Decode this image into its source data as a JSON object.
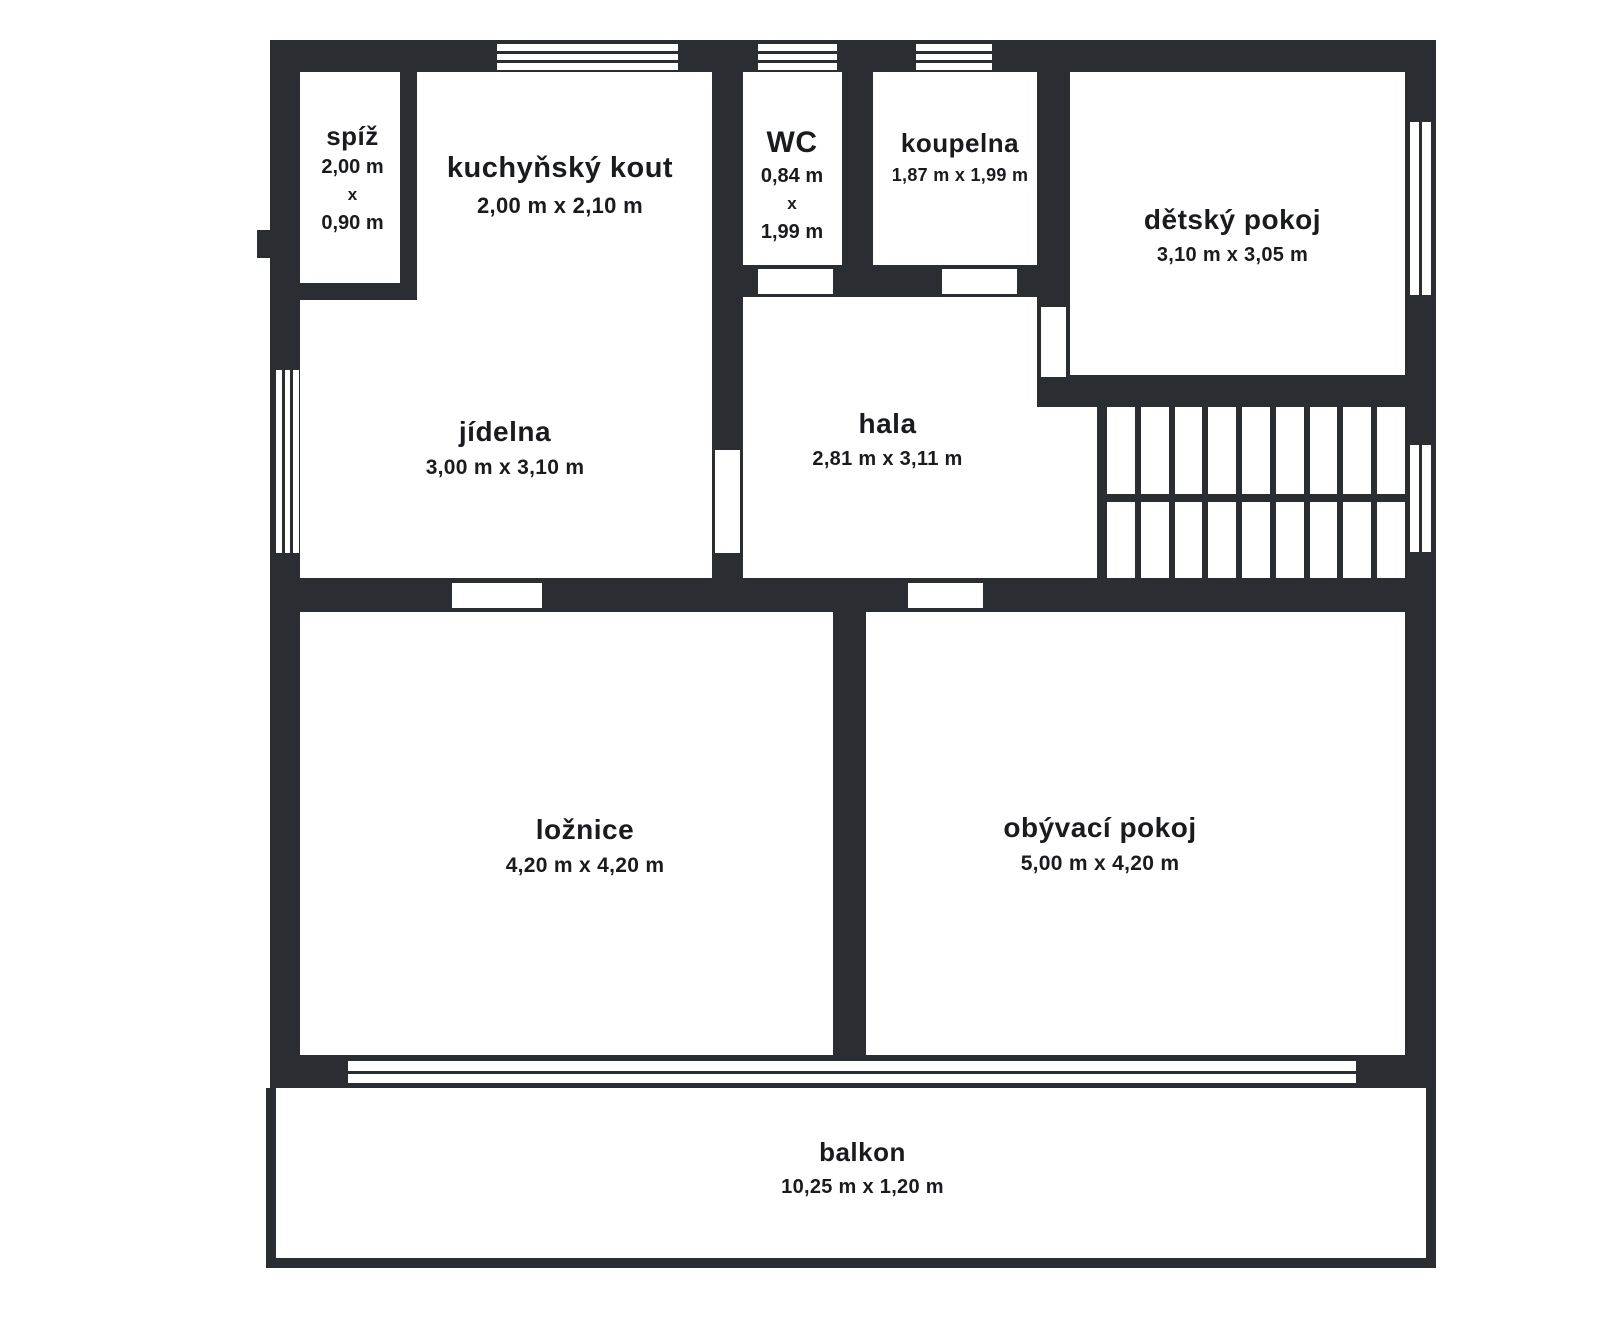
{
  "plan": {
    "wall_color": "#2a2d32",
    "text_color": "#191b1f",
    "background_color": "#ffffff",
    "rooms": [
      {
        "id": "spiz",
        "name": "spíž",
        "dims": [
          "2,00 m",
          "x",
          "0,90 m"
        ]
      },
      {
        "id": "kuchynsky-kout",
        "name": "kuchyňský kout",
        "dims": "2,00 m x 2,10 m"
      },
      {
        "id": "wc",
        "name": "WC",
        "dims": [
          "0,84 m",
          "x",
          "1,99 m"
        ]
      },
      {
        "id": "koupelna",
        "name": "koupelna",
        "dims": "1,87 m x 1,99 m"
      },
      {
        "id": "detsky-pokoj",
        "name": "dětský pokoj",
        "dims": "3,10 m x 3,05 m"
      },
      {
        "id": "jidelna",
        "name": "jídelna",
        "dims": "3,00 m x 3,10 m"
      },
      {
        "id": "hala",
        "name": "hala",
        "dims": "2,81 m x 3,11 m"
      },
      {
        "id": "loznice",
        "name": "ložnice",
        "dims": "4,20 m x 4,20 m"
      },
      {
        "id": "obyvaci-pokoj",
        "name": "obývací pokoj",
        "dims": "5,00 m x 4,20 m"
      },
      {
        "id": "balkon",
        "name": "balkon",
        "dims": "10,25 m x 1,20 m"
      }
    ]
  }
}
